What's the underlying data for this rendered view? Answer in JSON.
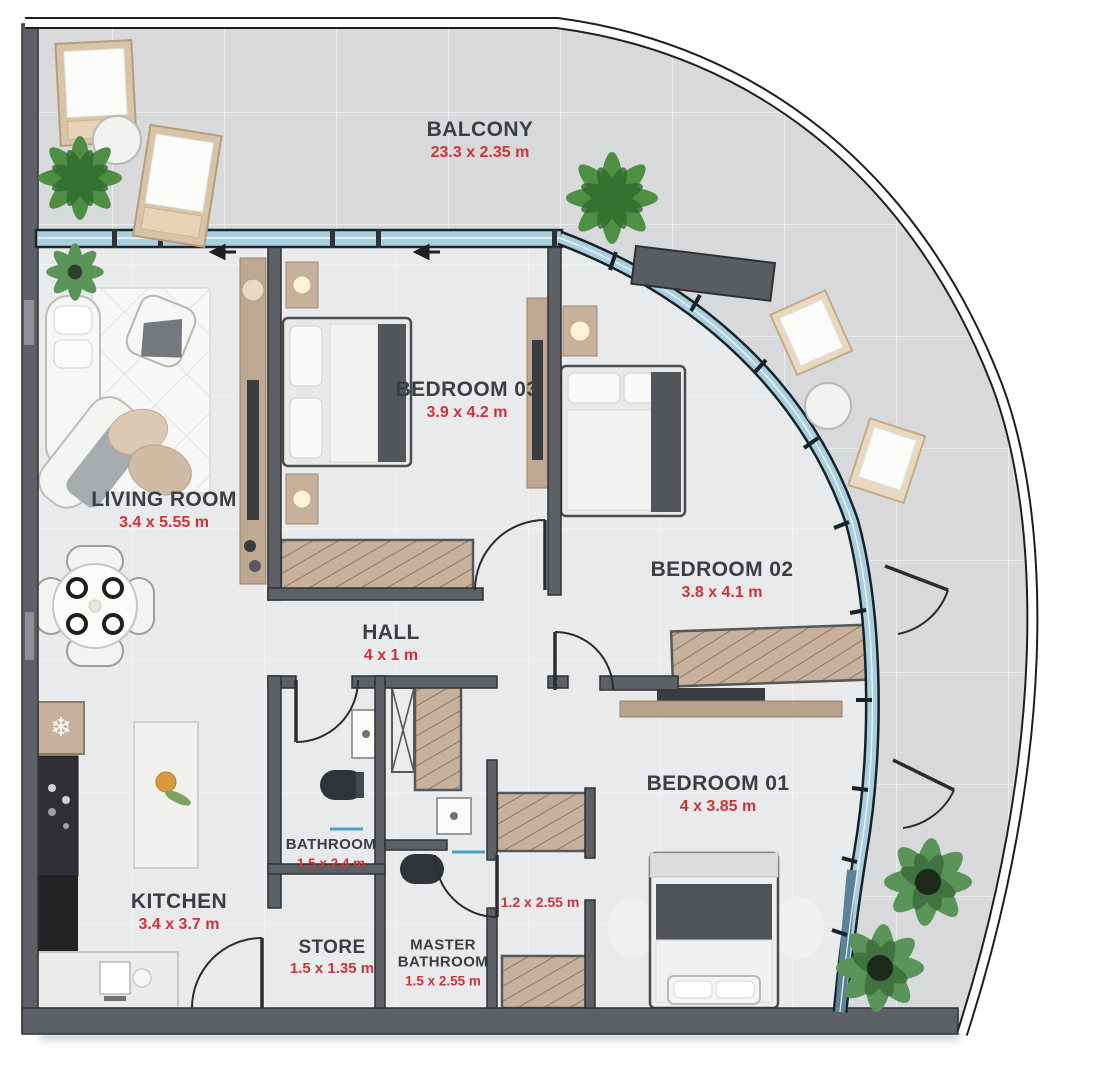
{
  "plan": {
    "type": "apartment-floor-plan",
    "rooms": [
      {
        "id": "balcony",
        "label": "BALCONY",
        "dims": "23.3 x 2.35 m"
      },
      {
        "id": "living-room",
        "label": "LIVING ROOM",
        "dims": "3.4 x 5.55 m"
      },
      {
        "id": "bedroom-03",
        "label": "BEDROOM 03",
        "dims": "3.9 x 4.2 m"
      },
      {
        "id": "bedroom-02",
        "label": "BEDROOM 02",
        "dims": "3.8 x 4.1 m"
      },
      {
        "id": "bedroom-01",
        "label": "BEDROOM 01",
        "dims": "4 x 3.85 m"
      },
      {
        "id": "hall",
        "label": "HALL",
        "dims": "4 x 1 m"
      },
      {
        "id": "kitchen",
        "label": "KITCHEN",
        "dims": "3.4 x 3.7 m"
      },
      {
        "id": "bathroom",
        "label": "BATHROOM",
        "dims": "1.5 x 2.4 m"
      },
      {
        "id": "store",
        "label": "STORE",
        "dims": "1.5 x 1.35 m"
      },
      {
        "id": "master-bathroom",
        "label": "MASTER BATHROOM",
        "dims": "1.5 x 2.55 m"
      }
    ],
    "extra_dimension": {
      "id": "wardrobe-area",
      "dims": "1.2 x 2.55 m"
    },
    "colors": {
      "label_text": "#3b3e42",
      "dims_text": "#cf3338",
      "wall": "#5d6064",
      "glass": "#a9cfdf",
      "floor_interior": "#e9eaeb",
      "floor_balcony": "#d7d9da",
      "wood": "#c7b19c",
      "plant_green": "#4e8f43"
    },
    "icons": {
      "fridge_snowflake": "❄"
    }
  }
}
